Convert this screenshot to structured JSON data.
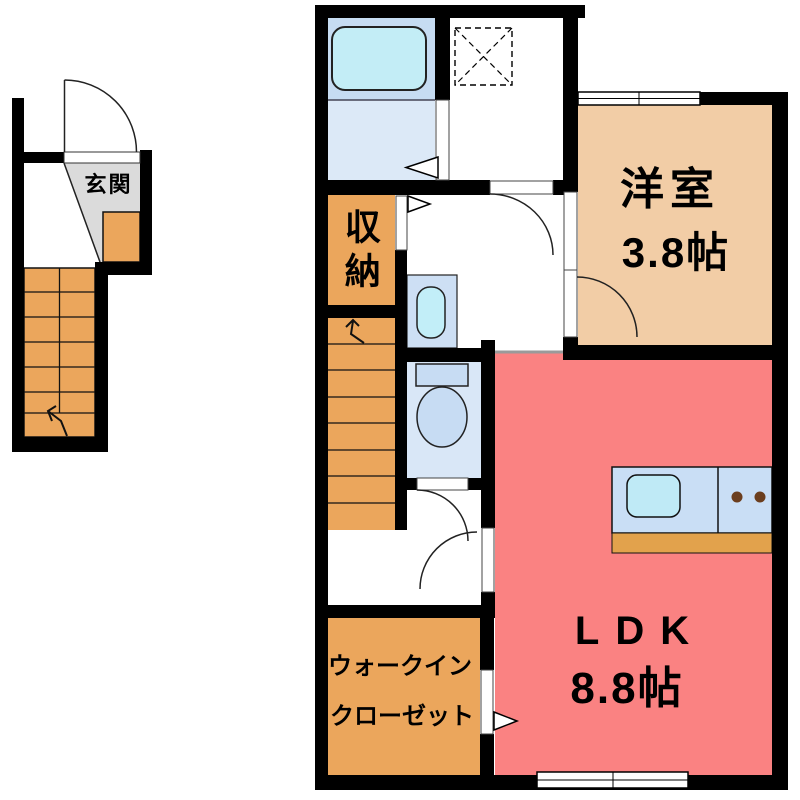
{
  "labels": {
    "genkan": "玄関",
    "storage": "収納",
    "bedroom_name": "洋室",
    "bedroom_size": "3.8帖",
    "ldk_name": "LDK",
    "ldk_size": "8.8帖",
    "wic_line1": "ウォークイン",
    "wic_line2": "クローゼット"
  },
  "rooms": [
    {
      "name": "玄関"
    },
    {
      "name": "収納"
    },
    {
      "name": "洋室",
      "size": "3.8帖"
    },
    {
      "name": "LDK",
      "size": "8.8帖"
    },
    {
      "name": "ウォークインクローゼット"
    }
  ],
  "colors": {
    "wall": "#000000",
    "ldk": "#FA8282",
    "bedroom": "#F2CDA6",
    "storage": "#EBA65C",
    "stairs": "#EBA65C",
    "wic": "#EBA65C",
    "genkan_floor": "#DBDBDB",
    "genkan_step": "#EBA65C",
    "bathroom_upper": "#C6DCF2",
    "bathroom_lower": "#DCE9F7",
    "bathtub": "#C3EDF6",
    "toilet_room": "#D9E7F7",
    "fixture_blue": "#C9DEF5",
    "sink_cyan": "#BFEAF6",
    "counter_base": "#E2A24C",
    "stove_dot": "#6B3E1E",
    "opening_line": "#9A9A9A"
  }
}
